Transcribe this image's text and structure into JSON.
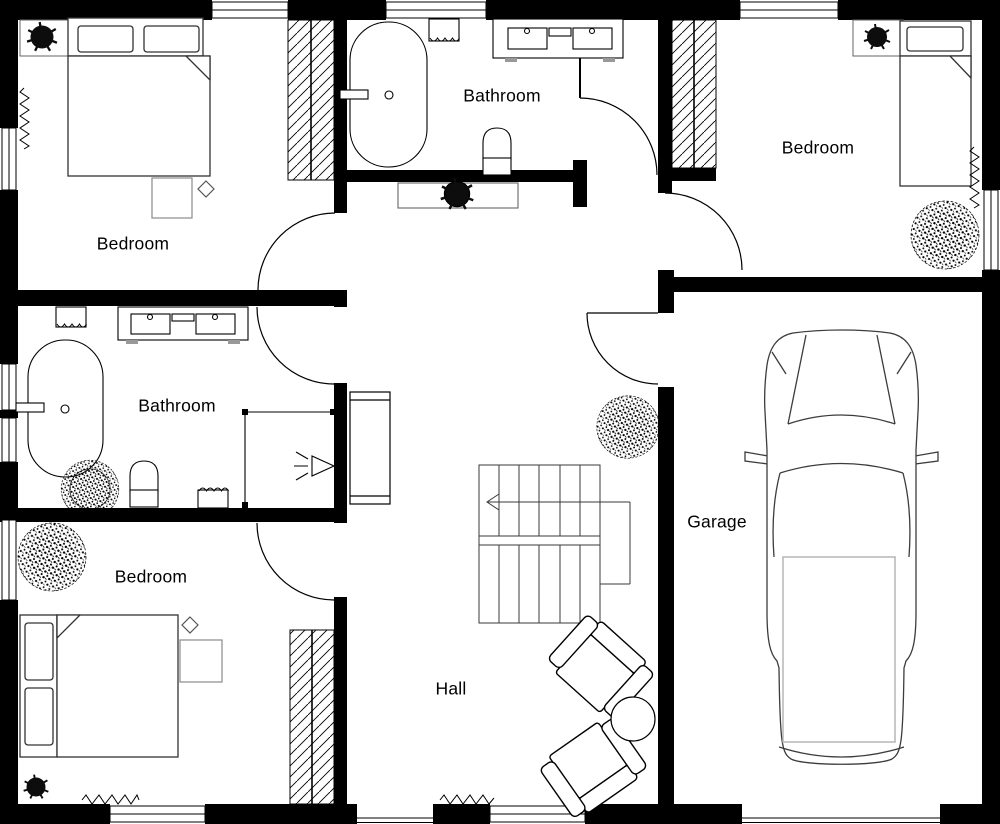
{
  "plan": {
    "rooms": [
      {
        "id": "bedroom-tl",
        "label": "Bedroom"
      },
      {
        "id": "bathroom-top",
        "label": "Bathroom"
      },
      {
        "id": "bedroom-tr",
        "label": "Bedroom"
      },
      {
        "id": "bathroom-ml",
        "label": "Bathroom"
      },
      {
        "id": "bedroom-bl",
        "label": "Bedroom"
      },
      {
        "id": "garage",
        "label": "Garage"
      },
      {
        "id": "hall",
        "label": "Hall"
      }
    ],
    "symbols": [
      "bed",
      "wardrobe",
      "bathtub",
      "double-sink-vanity",
      "toilet",
      "shower",
      "towel-basket",
      "plant",
      "radiator",
      "side-table",
      "lamp",
      "sideboard",
      "staircase",
      "armchair",
      "round-table",
      "cabinet",
      "car",
      "window",
      "door"
    ],
    "colors": {
      "wall": "#000000",
      "line": "#000000",
      "furniture": "#555555",
      "light": "#9a9a9a",
      "background": "#ffffff"
    }
  }
}
